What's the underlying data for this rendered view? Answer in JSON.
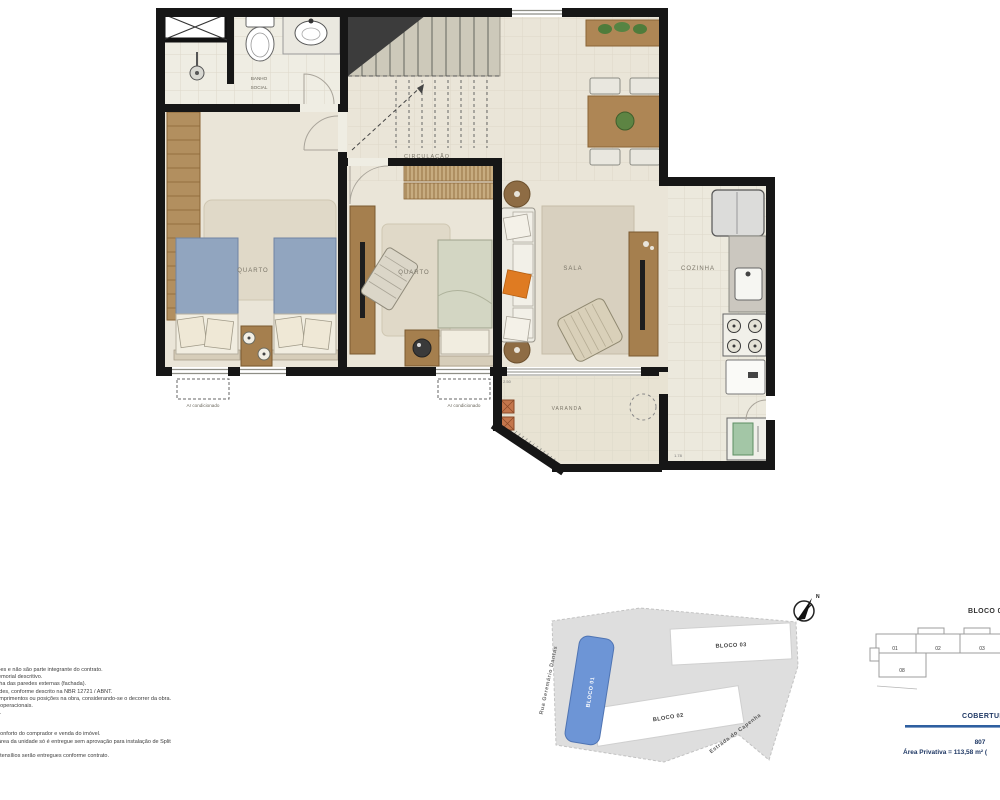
{
  "floorplan": {
    "labels": {
      "banho_line1": "BANHO",
      "banho_line2": "SOCIAL",
      "circulacao": "CIRCULAÇÃO",
      "quarto1": "QUARTO",
      "quarto2": "QUARTO",
      "sala": "SALA",
      "cozinha": "COZINHA",
      "varanda": "VARANDA",
      "ac1": "Ar condicionado",
      "ac2": "Ar condicionado",
      "dim_varanda": "2.50",
      "dim_cozinha": "1.78"
    }
  },
  "disclaimer": {
    "lines": [
      "são meras sugestões e não são parte integrante do contrato.",
      "tadas conforme memorial descritivo.",
      "da entrega pela linha das paredes externas (fachada).",
      "ção entre as unidades, conforme descrito na NBR 12721 / ABNT.",
      ", diferença s/ ar comprimentos ou posições na obra, considerando-se o decorrer da obra.",
      "não mobiliadas ou operacionais.",
      "ção e apresentada.",
      "instalados para o conforto do comprador e venda do imóvel.",
      "são sugestivos. A área da unidade só é entregue sem aprovação para instalação de Split",
      "vas.",
      "de restrições. Os utensílios serão entregues conforme contrato."
    ]
  },
  "siteplan": {
    "bloco01": "BLOCO 01",
    "bloco02": "BLOCO 02",
    "bloco03": "BLOCO 03",
    "road_left": "Rua  Geremário  Dantas",
    "road_bottom": "Estrada do Capenha",
    "compass_n": "N",
    "highlight_color": "#6D95D6"
  },
  "keyplan": {
    "title": "BLOCO 03",
    "units": {
      "u1": "01",
      "u2": "02",
      "u3": "03",
      "u8": "08"
    },
    "section": "COBERTURA",
    "unit_number": "807",
    "area": "Área Privativa = 113,58 m² (",
    "accent_color": "#1F3864",
    "line_color": "#2E5FA0"
  }
}
